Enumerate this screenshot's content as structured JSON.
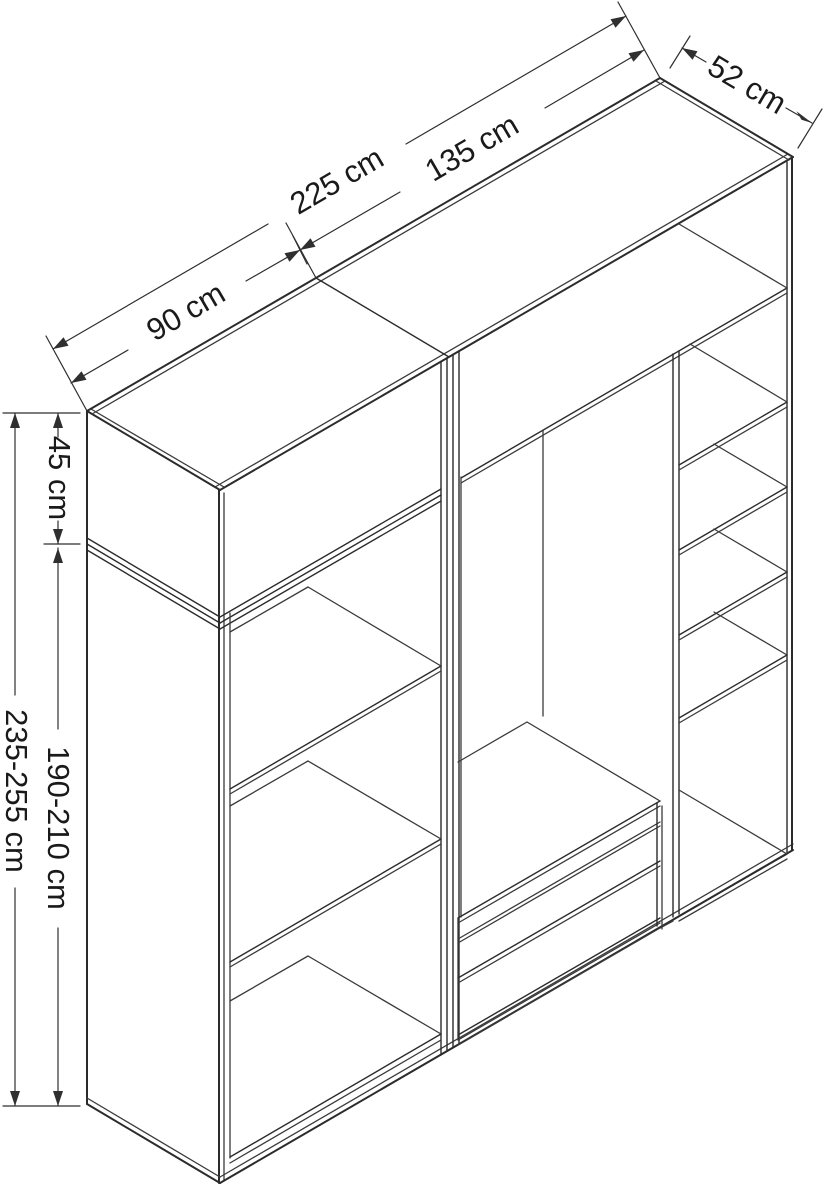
{
  "drawing": {
    "type": "isometric-furniture-dimension-diagram",
    "subject": "two-module wardrobe with open shelves and two drawers",
    "background_color": "#ffffff",
    "line_color": "#2b2b2b",
    "text_color": "#1a1a1a",
    "dimensions": {
      "total_width": "225 cm",
      "left_module_width": "90 cm",
      "right_module_width": "135 cm",
      "depth": "52 cm",
      "top_section_height": "45 cm",
      "lower_section_height": "190-210 cm",
      "total_height": "235-255 cm"
    }
  }
}
